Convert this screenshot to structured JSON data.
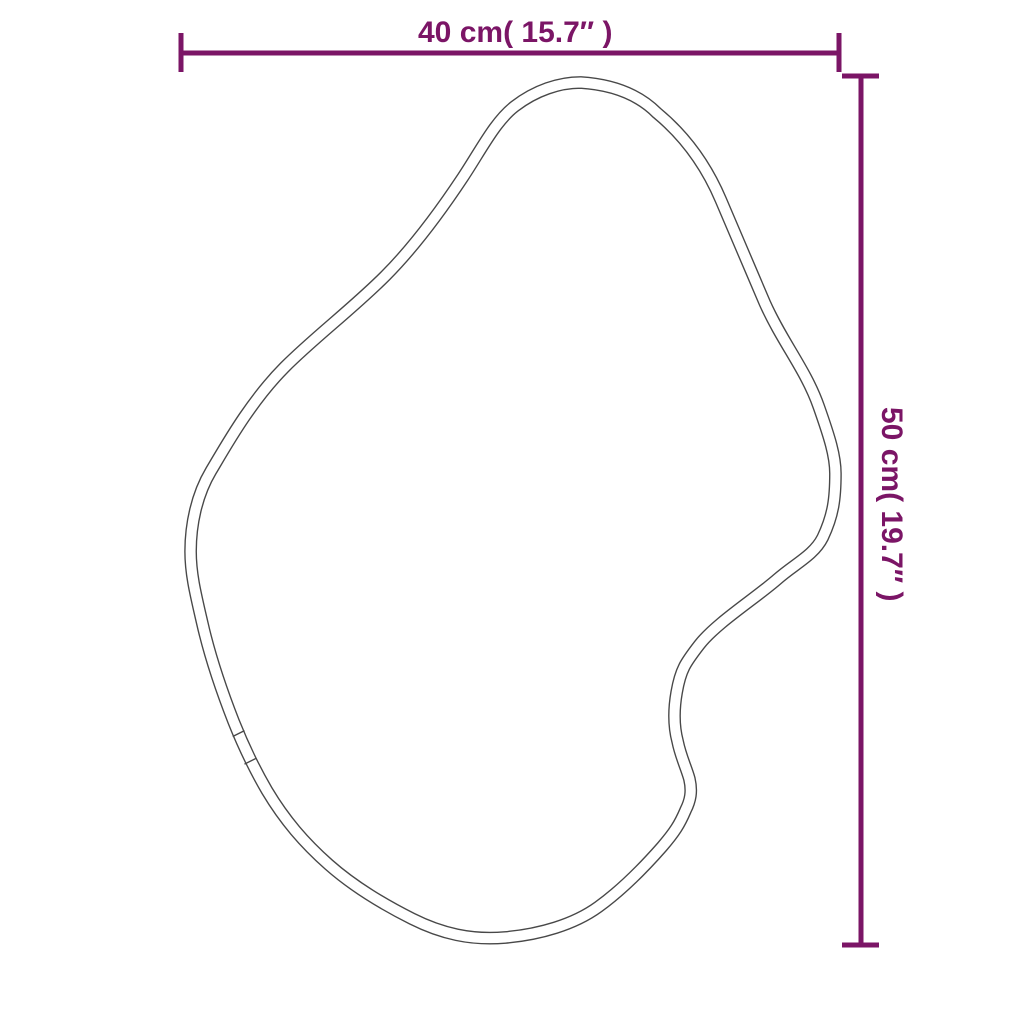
{
  "diagram": {
    "kind": "product dimension diagram",
    "shape": "irregular organic mirror outline with double-line frame and two seam marks",
    "width_dimension": {
      "label": "40 cm( 15.7″ )",
      "value_cm": "40 cm",
      "value_inch": "15.7″"
    },
    "height_dimension": {
      "label": "50 cm( 19.7″ )",
      "value_cm": "50 cm",
      "value_inch": "19.7″"
    }
  },
  "colors": {
    "dimension": "#7B1566",
    "outline": "#484848",
    "background": "#FFFFFF"
  }
}
